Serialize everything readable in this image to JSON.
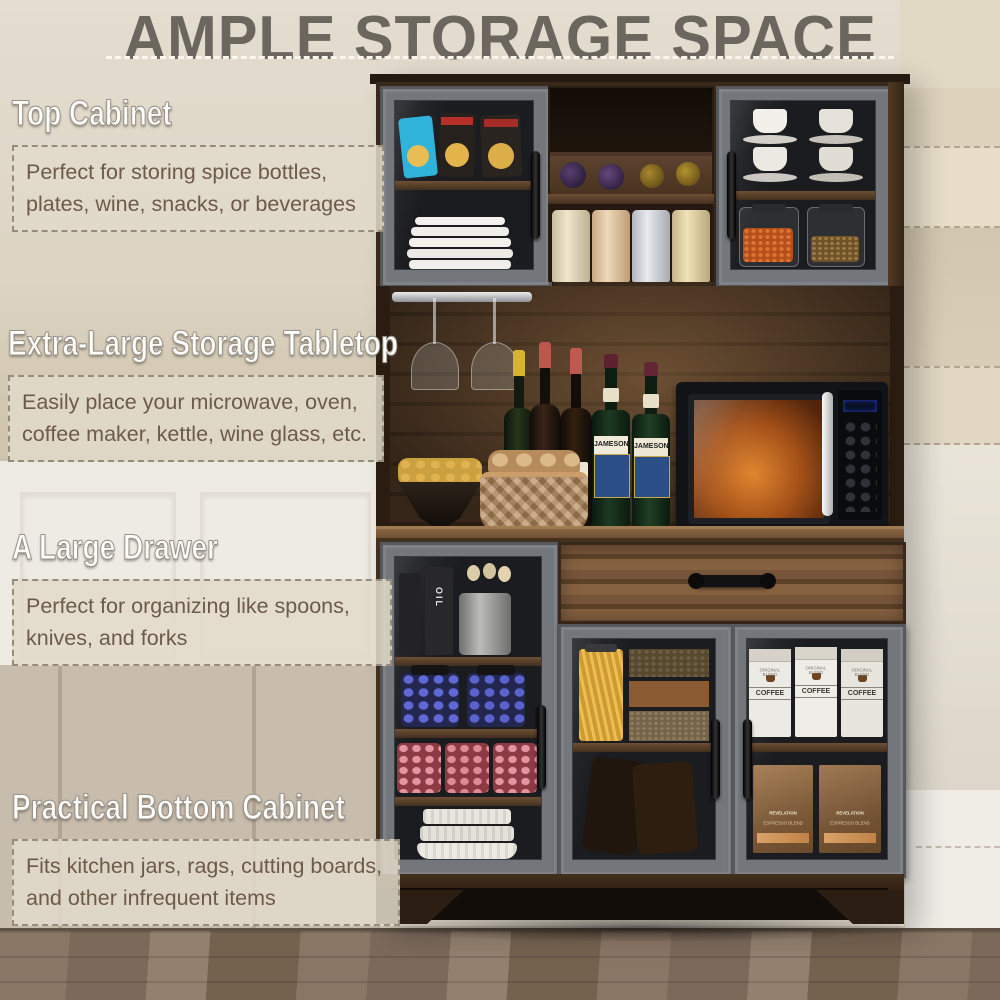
{
  "title": "AMPLE STORAGE SPACE",
  "sections": [
    {
      "heading": "Top Cabinet",
      "body": "Perfect for storing spice bottles, plates, wine, snacks, or beverages"
    },
    {
      "heading": "Extra-Large Storage Tabletop",
      "body": "Easily place your microwave, oven, coffee maker, kettle, wine glass, etc."
    },
    {
      "heading": "A Large Drawer",
      "body": "Perfect for organizing like spoons, knives, and forks"
    },
    {
      "heading": "Practical Bottom Cabinet",
      "body": "Fits kitchen jars, rags, cutting boards, and other infrequent items"
    }
  ],
  "photo": {
    "labels": {
      "oil": "OIL",
      "whiskey": "JAMESON",
      "coffee_brand": "ORIGINAL BLEND",
      "coffee": "COFFEE",
      "espresso": "REVELATION",
      "espresso_sub": "ESPRESSO BLEND"
    }
  },
  "colors": {
    "wall_beige": "#dcd4c5",
    "wall_white": "#edeae4",
    "wood_dark": "#3a2a1c",
    "wood_mid": "#6e4f35",
    "door_gray": "#73767b",
    "title_gray": "#6b675f",
    "text_brown": "#6d5a4a",
    "floor_brown": "#7c6a5a"
  }
}
